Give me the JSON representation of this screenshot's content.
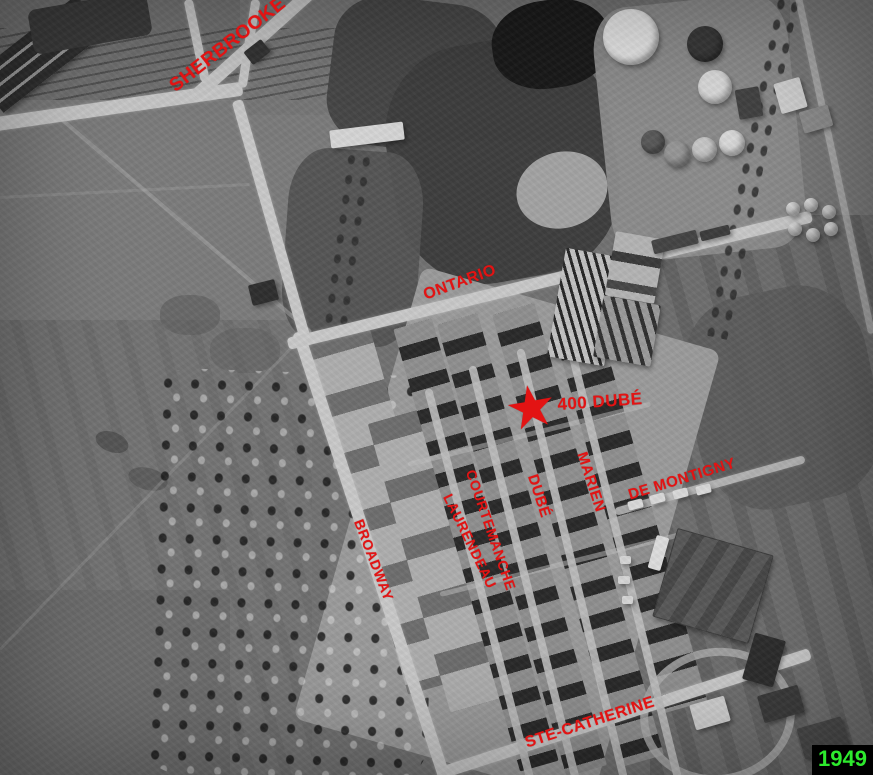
{
  "annotations": {
    "streets": {
      "sherbrooke": "SHERBROOKE",
      "ontario": "ONTARIO",
      "broadway": "BROADWAY",
      "laurendeau": "LAURENDEAU",
      "courtemanche": "COURTEMANCHE",
      "dube": "DUBÉ",
      "marien": "MARIEN",
      "de_montigny": "DE MONTIGNY",
      "ste_catherine": "STE-CATHERINE"
    },
    "marker": {
      "symbol": "★",
      "label": "400 DUBÉ"
    },
    "year": "1949",
    "colors": {
      "annotation_red": "#e31313",
      "year_text_green": "#2dea2d",
      "year_bg_black": "#000000"
    }
  }
}
